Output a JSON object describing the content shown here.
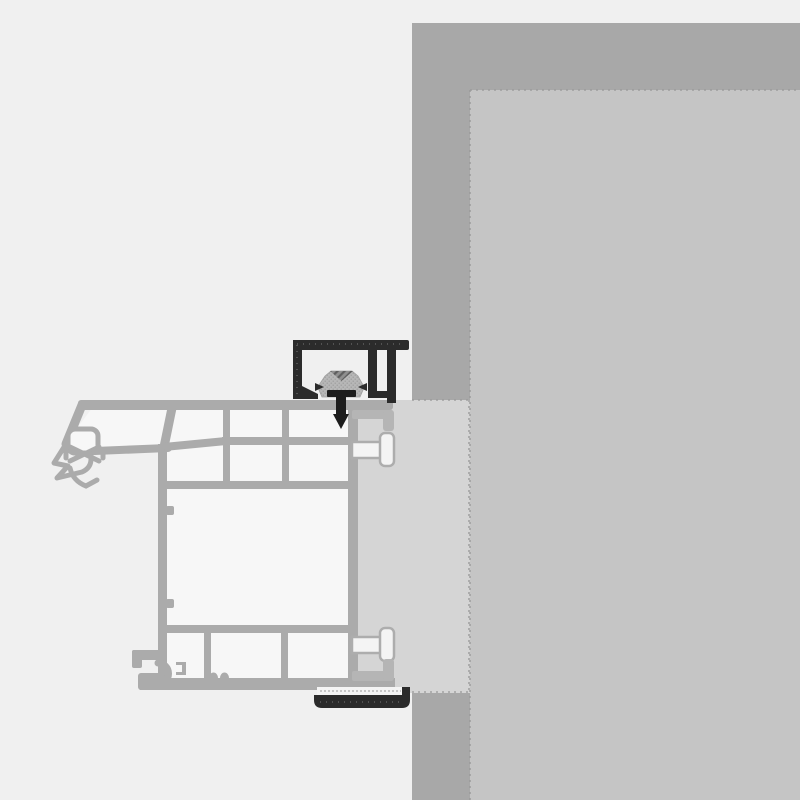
{
  "diagram": {
    "title": "window-frame-to-wall-installation-cross-section",
    "components": {
      "wall_outer": "masonry-wall-outer-face",
      "wall_reveal": "wall-reveal-inner-face",
      "frame_zone": "frame-overlap-zone",
      "profile": "pvc-window-frame-profile-section",
      "gasket": "coextruded-gasket-seal",
      "bracket": "black-installation-bracket-track",
      "clip": "fixing-clip",
      "screw": "fastening-screw",
      "dowels": "frame-anchor-plugs",
      "channel": "bottom-black-channel-profile"
    }
  },
  "palette": {
    "bg": "#f0f0f0",
    "wall": "#a8a8a8",
    "reveal": "#c5c5c5",
    "zone": "#d5d5d5",
    "profile": "#ababab",
    "cavity": "#f7f7f7",
    "black": "#2b2b2b",
    "clip": "#b7b7b7",
    "clip_dot": "#9c9c9c",
    "hatch_dark": "#5f5f5f",
    "hatch_base": "#8f8f8f",
    "screw": "#1d1d1d",
    "fin": "#b5b5b5",
    "dowel_fill": "#f4f4f4",
    "dowel_stroke": "#adadad",
    "dash": "#979797",
    "strip": "#f4f4f4"
  }
}
